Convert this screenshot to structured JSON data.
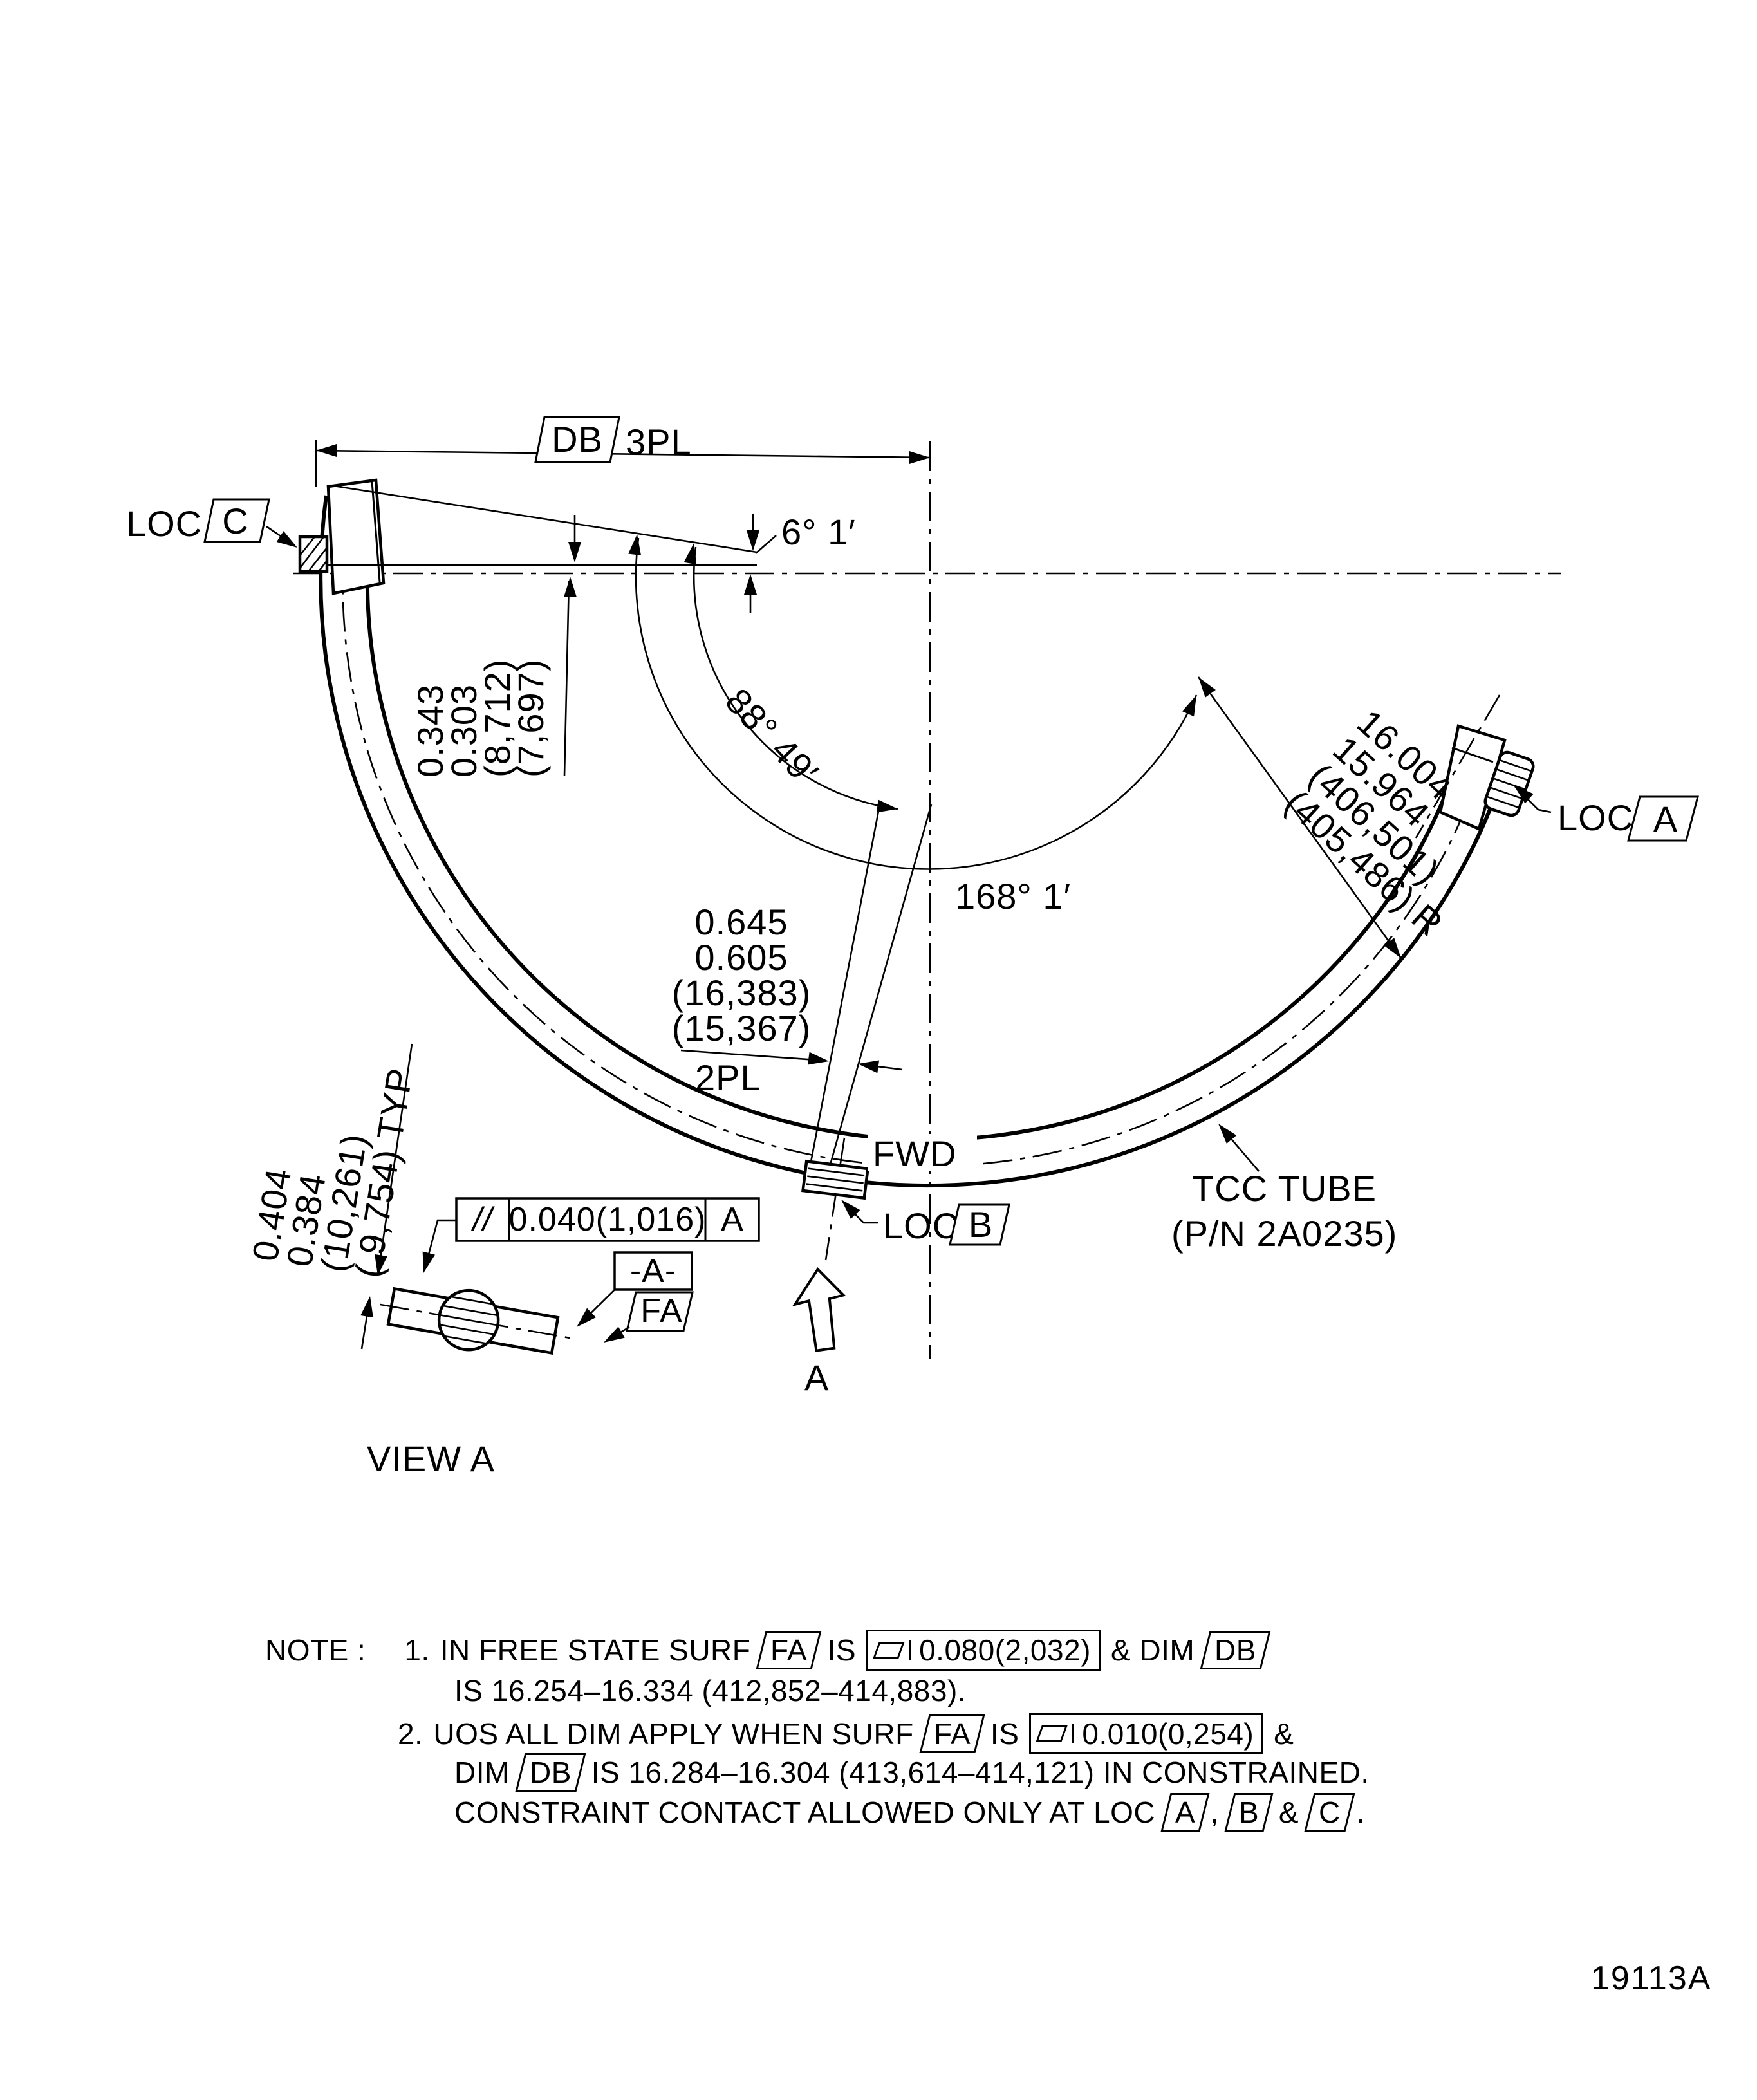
{
  "figure_id": "19113A",
  "labels": {
    "db": "DB",
    "threepl": "3PL",
    "loc": "LOC",
    "flag_a": "A",
    "flag_b": "B",
    "flag_c": "C",
    "angle_6": "6° 1′",
    "angle_88": "88° 49′",
    "angle_168": "168° 1′",
    "fwd": "FWD",
    "part_name": "TCC TUBE",
    "part_number": "(P/N 2A0235)",
    "view_label": "VIEW A",
    "view_arrow": "A",
    "datum_flag": "-A-",
    "surf_flag": "FA"
  },
  "fcf_view": {
    "sym": "//",
    "value": "0.040(1,016)",
    "datum": "A"
  },
  "dims": {
    "gap": [
      "0.343",
      "0.303",
      "(8,712)",
      "(7,697)"
    ],
    "radius": [
      "16.004",
      "15.964",
      "(406,501)",
      "(405,486) R"
    ],
    "slot": [
      "0.645",
      "0.605",
      "(16,383)",
      "(15,367)"
    ],
    "slot_places": "2PL",
    "wall": [
      "0.404",
      "0.384",
      "(10,261)",
      "( 9,754) TYP"
    ]
  },
  "notes": {
    "label": "NOTE :",
    "n1_num": "1.",
    "n1_pre": "IN FREE STATE SURF",
    "n1_flag1": "FA",
    "n1_is": "IS",
    "n1_fcf": "0.080(2,032)",
    "n1_mid": "& DIM",
    "n1_flag2": "DB",
    "n1_line2": "IS 16.254–16.334 (412,852–414,883).",
    "n2_num": "2.",
    "n2_pre": "UOS ALL DIM APPLY WHEN SURF",
    "n2_flag1": "FA",
    "n2_is": "IS",
    "n2_fcf": "0.010(0,254)",
    "n2_amp": "&",
    "n2_l2a": "DIM",
    "n2_flag2": "DB",
    "n2_l2b": "IS 16.284–16.304 (413,614–414,121) IN CONSTRAINED.",
    "n2_l3a": "CONSTRAINT CONTACT ALLOWED ONLY AT LOC",
    "n2_flagA": "A",
    "n2_comma": ",",
    "n2_flagB": "B",
    "n2_amp2": "&",
    "n2_flagC": "C",
    "n2_period": "."
  }
}
